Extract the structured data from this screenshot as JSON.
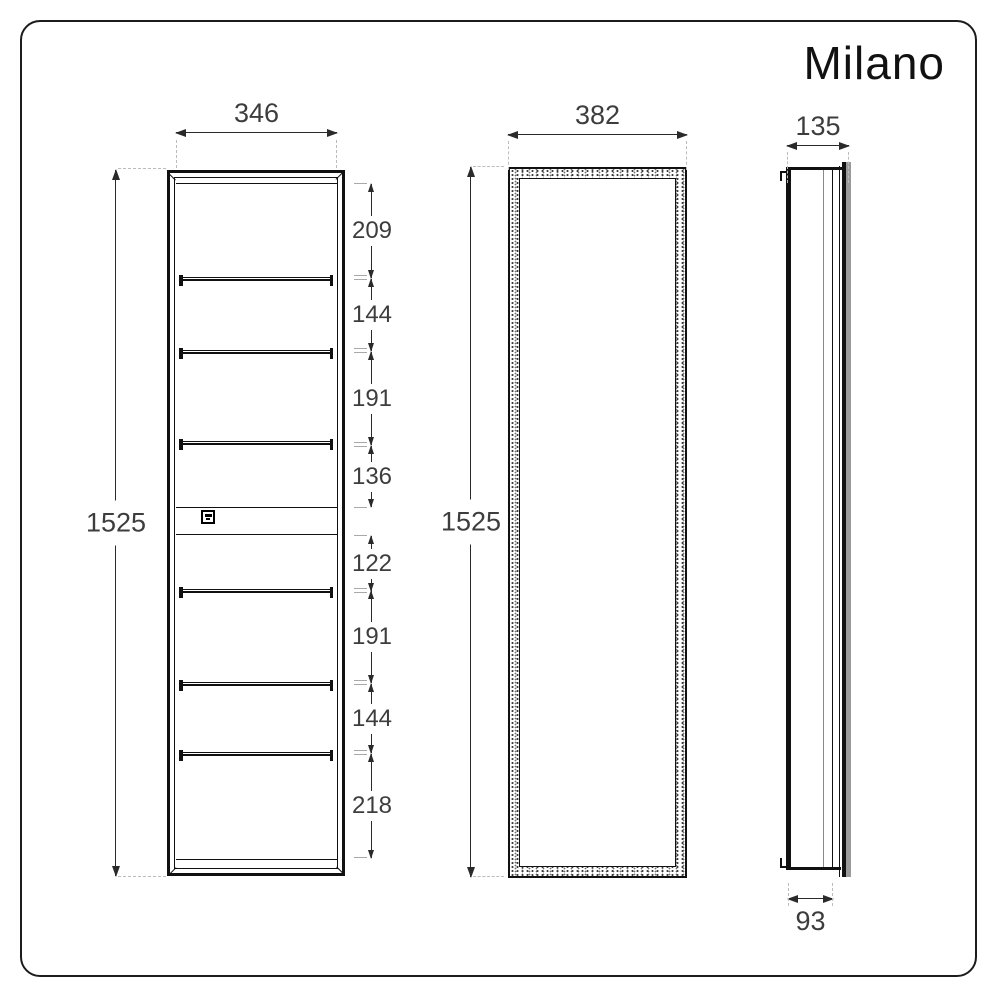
{
  "brand": "Milano",
  "front_view": {
    "name": "front elevation with shelves",
    "width": "346",
    "height": "1525",
    "spacings": [
      "209",
      "144",
      "191",
      "136",
      "122",
      "191",
      "144",
      "218"
    ],
    "socket_icon": "shaver-socket"
  },
  "door_view": {
    "name": "front elevation mirrored door",
    "width": "382",
    "height": "1525"
  },
  "side_view": {
    "name": "side elevation",
    "width": "135",
    "depth": "93"
  }
}
